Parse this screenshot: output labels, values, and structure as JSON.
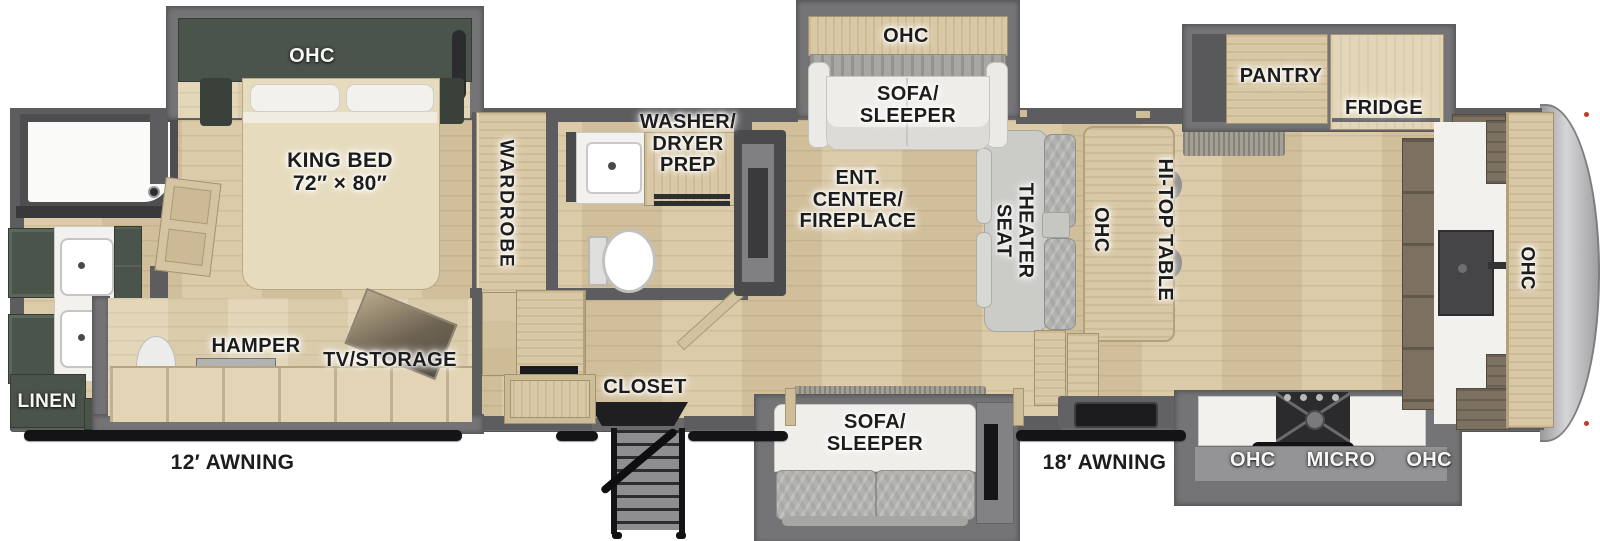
{
  "title": "Fifth wheel RV floor plan",
  "bedroom": {
    "ohc": "OHC",
    "bed": "KING BED",
    "bed_size": "72″ × 80″",
    "wardrobe": "WARDROBE",
    "hamper": "HAMPER",
    "tv_storage": "TV/STORAGE"
  },
  "rear_bath": {
    "linen": "LINEN"
  },
  "mid_bath": {
    "washer1": "WASHER/",
    "washer2": "DRYER",
    "washer3": "PREP"
  },
  "living": {
    "ohc_sofa": "OHC",
    "sofa1": "SOFA/",
    "sofa2": "SLEEPER",
    "ent1": "ENT.",
    "ent2": "CENTER/",
    "ent3": "FIREPLACE",
    "theater1": "THEATER",
    "theater2": "SEAT",
    "ohc_table": "OHC",
    "hitop": "HI-TOP TABLE"
  },
  "entry": {
    "closet": "CLOSET"
  },
  "kitchen": {
    "pantry": "PANTRY",
    "fridge": "FRIDGE",
    "ohc_left": "OHC",
    "micro": "MICRO",
    "ohc_right": "OHC",
    "ohc_front": "OHC"
  },
  "patio": {
    "sofa1": "SOFA/",
    "sofa2": "SLEEPER",
    "awning_12": "12′ AWNING",
    "awning_18": "18′ AWNING"
  },
  "colors": {
    "cabinet_green": "#4b544b",
    "wood": "#d9c8a5",
    "wall": "#5d5d5f",
    "awning": "#141416"
  }
}
